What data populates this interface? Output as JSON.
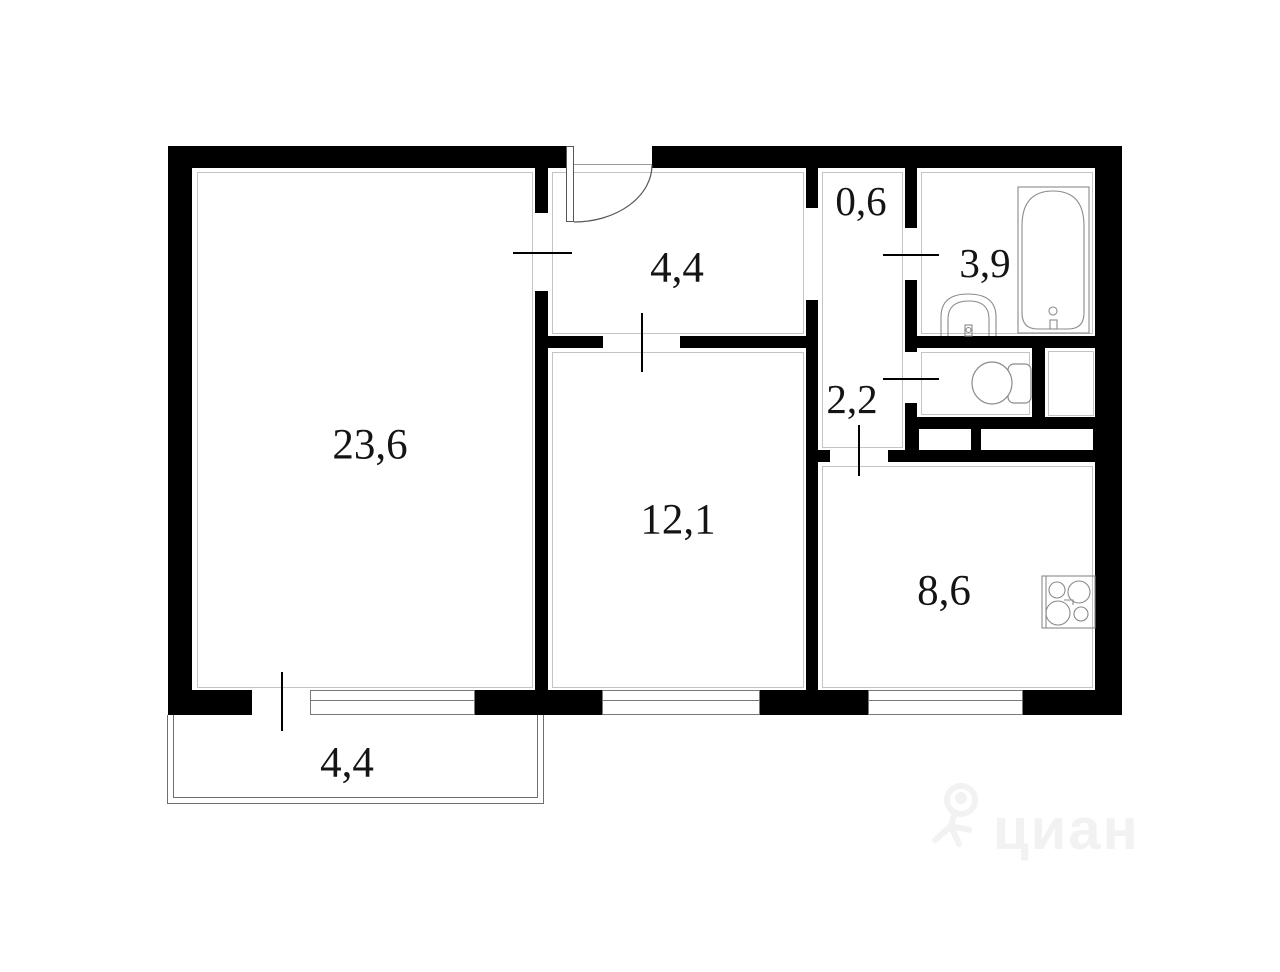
{
  "plan": {
    "type": "apartment-floor-plan",
    "rooms": [
      {
        "name": "living-room",
        "label": "23,6"
      },
      {
        "name": "hallway",
        "label": "4,4"
      },
      {
        "name": "closet",
        "label": "0,6"
      },
      {
        "name": "bathroom",
        "label": "3,9"
      },
      {
        "name": "corridor",
        "label": "2,2"
      },
      {
        "name": "bedroom",
        "label": "12,1"
      },
      {
        "name": "kitchen",
        "label": "8,6"
      },
      {
        "name": "balcony",
        "label": "4,4"
      }
    ],
    "fixtures": [
      "bathtub",
      "sink",
      "toilet",
      "stove"
    ],
    "watermark": {
      "text": "циан"
    },
    "colors": {
      "wall": "#000000",
      "background": "#ffffff",
      "thin_line": "#787878",
      "label": "#141414",
      "watermark": "#f2f2f2"
    }
  }
}
